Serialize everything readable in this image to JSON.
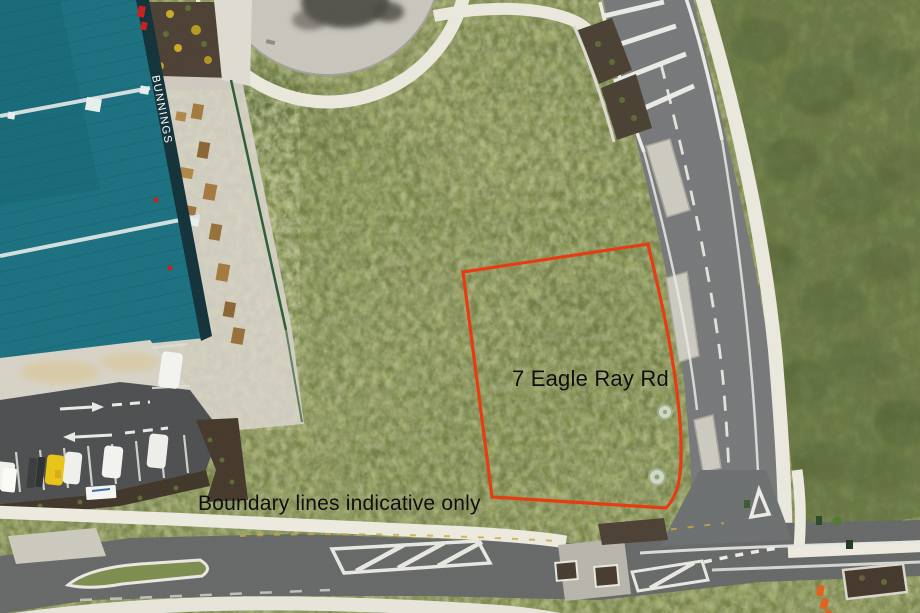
{
  "scene": {
    "type": "aerial-photograph-real-estate",
    "property_label": "7 Eagle Ray Rd",
    "disclaimer": "Boundary lines indicative only",
    "building_sign": "BUNNINGS"
  },
  "colors": {
    "boundary_line": "#e63a10",
    "label_text": "#0e0e0e",
    "building_roof": "#1b7080",
    "building_facade": "#14323a",
    "brand_red": "#c8201d",
    "grass_field": "#94a05c",
    "scrub": "#76874b",
    "asphalt_side_road": "#767879",
    "asphalt_main_road": "#666968",
    "concrete": "#cdc9be",
    "footpath": "#eae7dc",
    "mulch_garden": "#4c4134",
    "cone_orange": "#e2601f",
    "yellow_car": "#e8c417"
  }
}
